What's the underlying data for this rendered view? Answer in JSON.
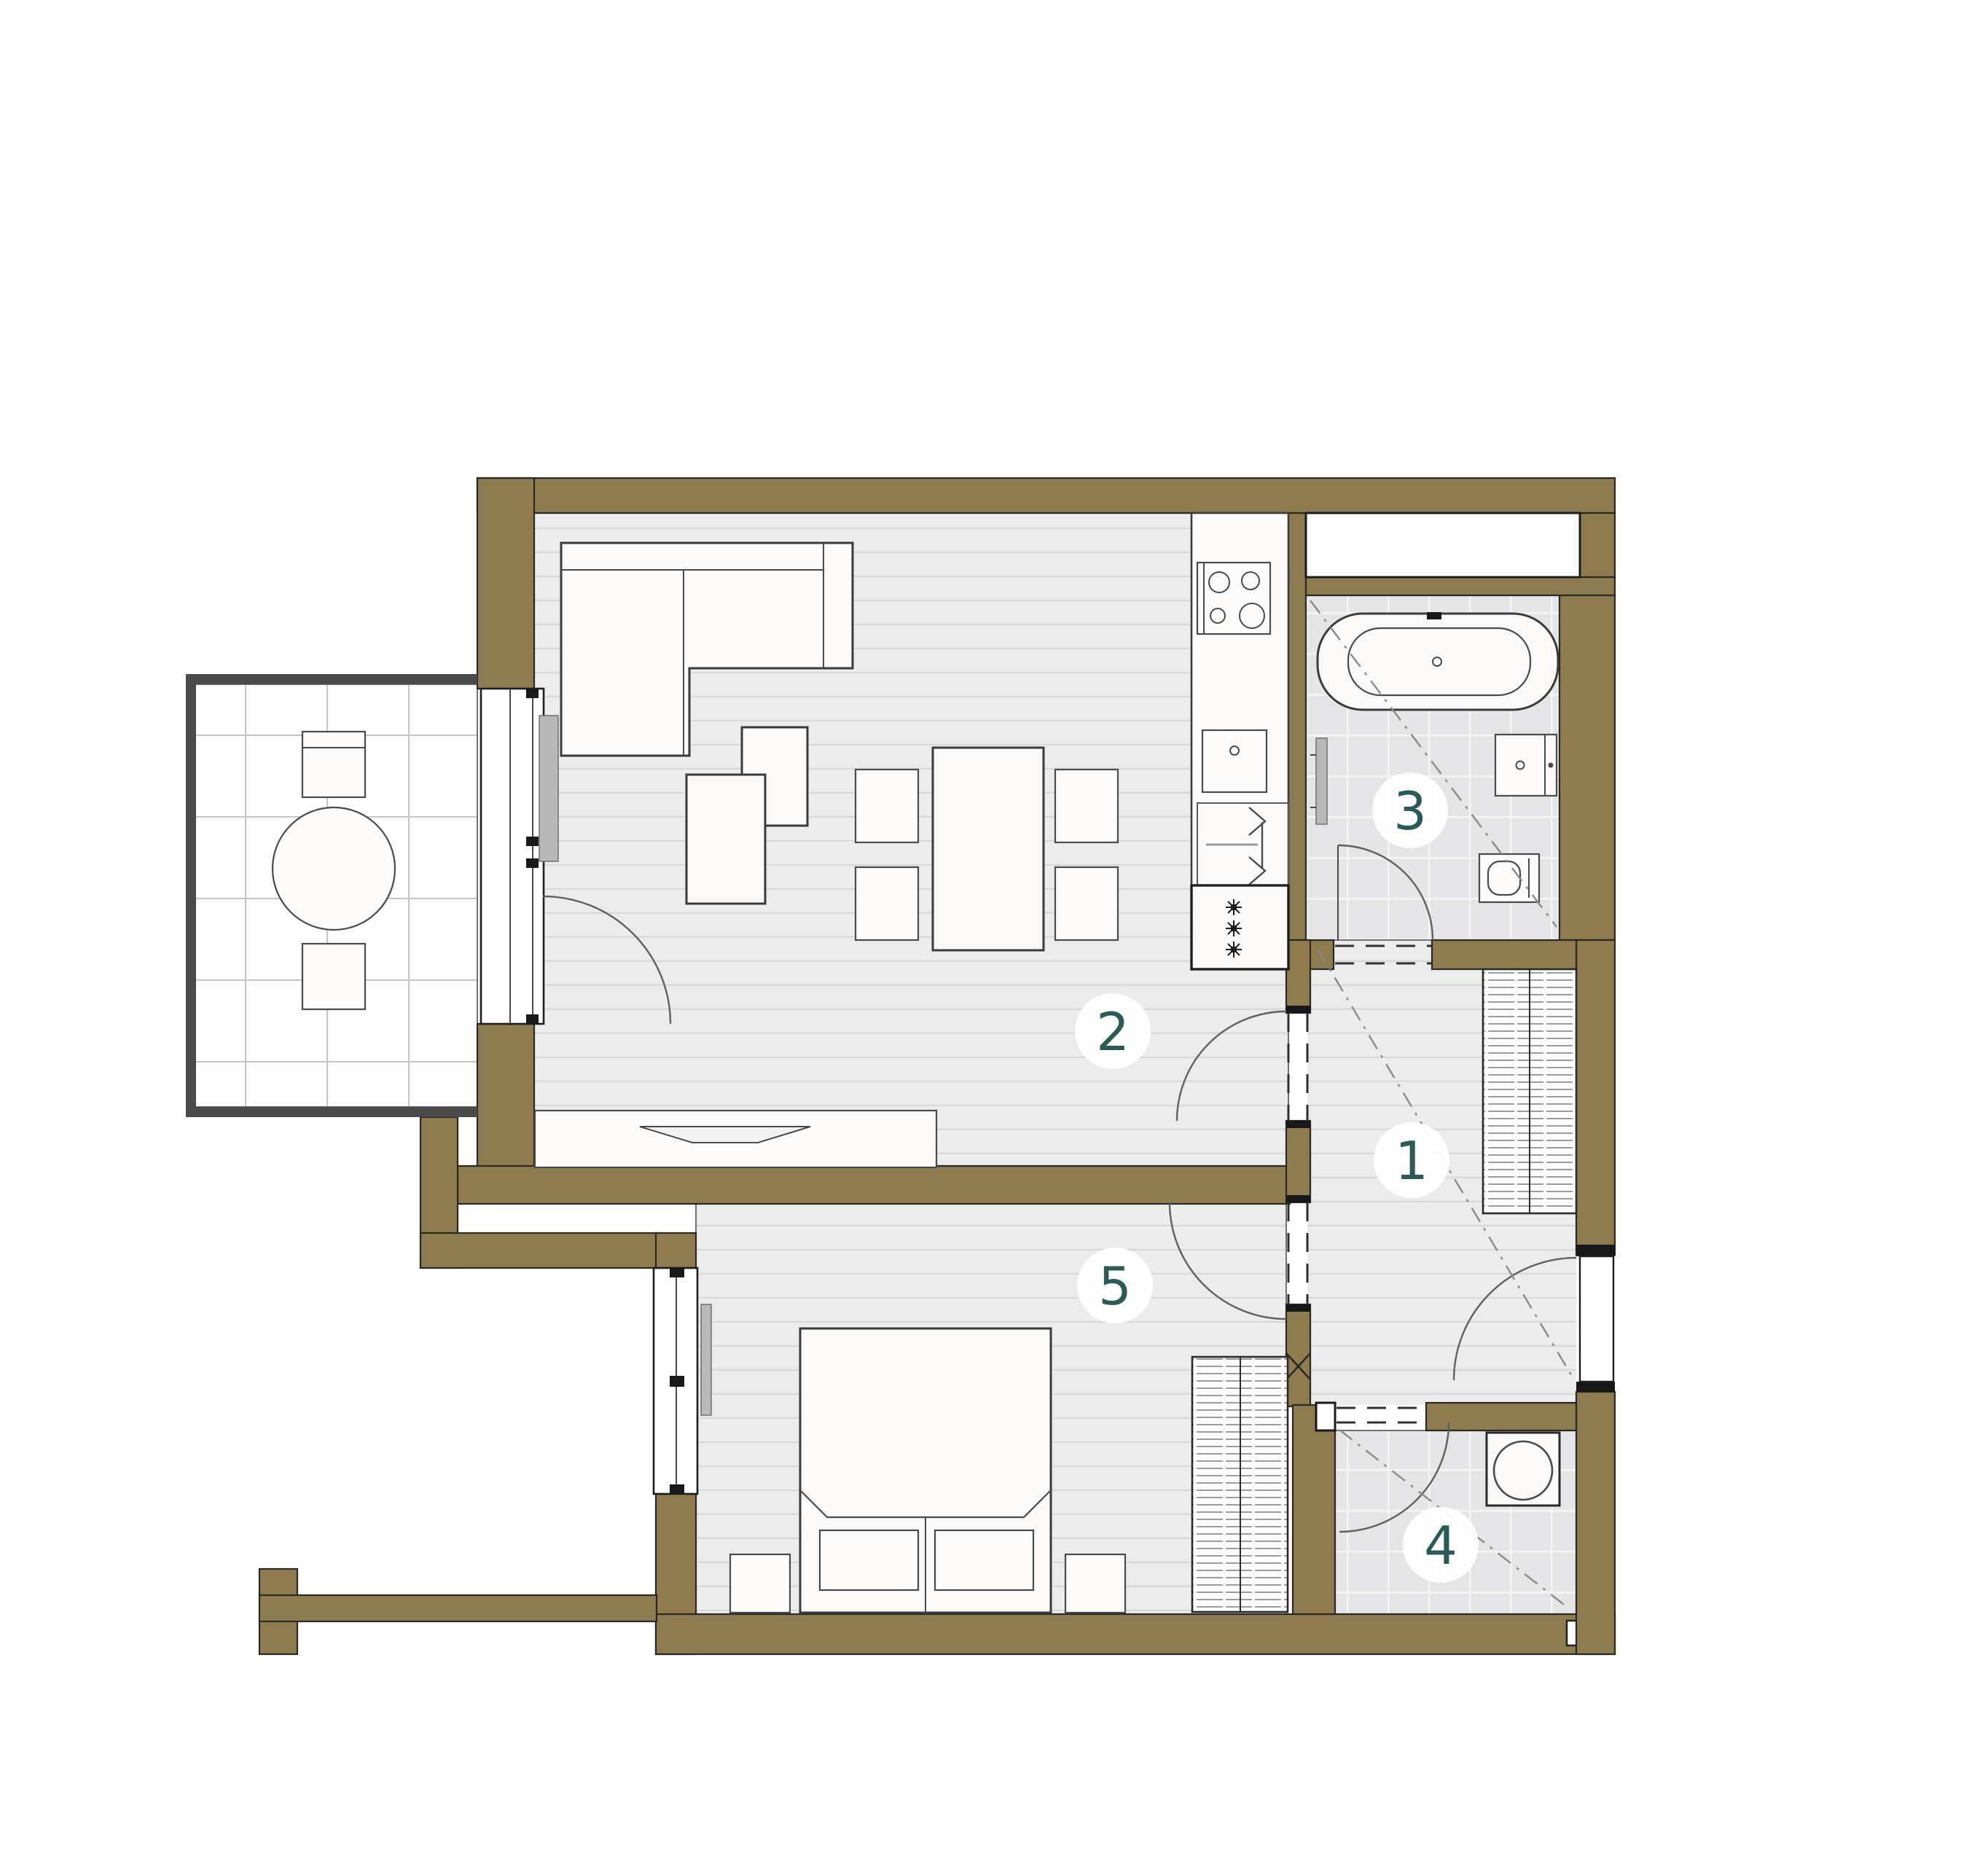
{
  "plan": {
    "type": "apartment-floor-plan",
    "rooms": [
      {
        "id": 1,
        "label": "1",
        "area_name": "hallway"
      },
      {
        "id": 2,
        "label": "2",
        "area_name": "living-room-kitchen"
      },
      {
        "id": 3,
        "label": "3",
        "area_name": "bathroom"
      },
      {
        "id": 4,
        "label": "4",
        "area_name": "utility-room"
      },
      {
        "id": 5,
        "label": "5",
        "area_name": "bedroom"
      }
    ],
    "fixtures": [
      "balcony-table",
      "balcony-chairs",
      "sofa",
      "lounge-chairs",
      "dining-table",
      "dining-chairs",
      "tv-sideboard",
      "kitchen-counter",
      "cooktop",
      "kitchen-sink",
      "dishwasher",
      "fridge-freezer",
      "bathtub",
      "vanity-sink",
      "toilet",
      "towel-radiator",
      "wardrobe-hall",
      "wardrobe-bedroom",
      "double-bed",
      "nightstands",
      "washing-machine",
      "entrance-door",
      "balcony-door",
      "bedroom-window",
      "shaft"
    ],
    "colors": {
      "wall": "#8e7c50",
      "wall_outline": "#2b2822",
      "room_number": "#2c5a57",
      "wood_floor": "#ececed",
      "tile_floor": "#e5e5e7",
      "balcony_floor": "#fdfdfd",
      "railing": "#4a4a4a",
      "background": "#ffffff"
    }
  }
}
